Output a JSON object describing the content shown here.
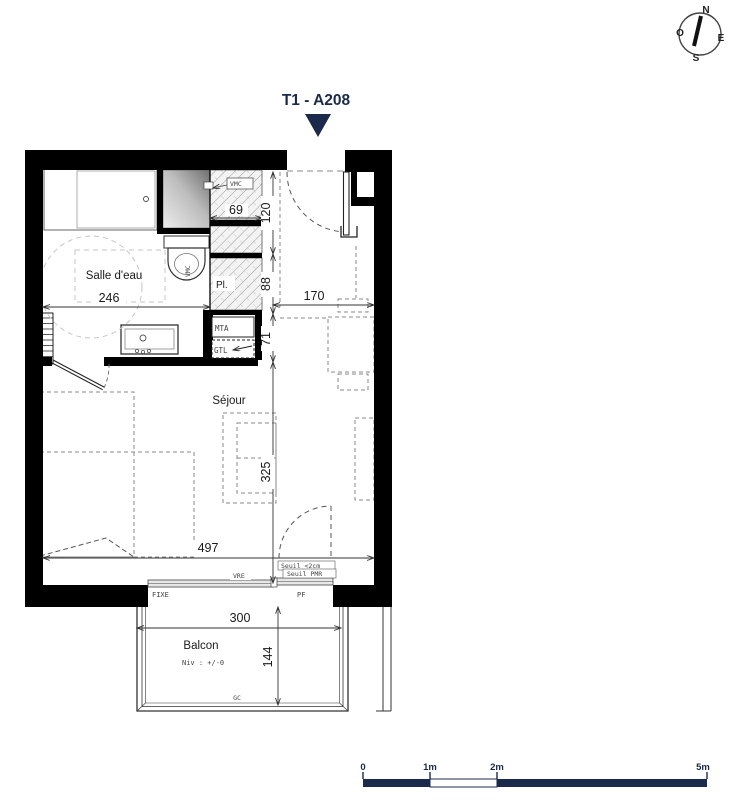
{
  "title": "T1 - A208",
  "compass": {
    "n": "N",
    "o": "O",
    "e": "E",
    "s": "S"
  },
  "rooms": {
    "bathroom": "Salle d'eau",
    "living": "Séjour",
    "balcony": "Balcon",
    "closet": "Pl."
  },
  "dims": {
    "d246": "246",
    "d69": "69",
    "d120": "120",
    "d88": "88",
    "d170": "170",
    "d71": "71",
    "d325": "325",
    "d497": "497",
    "d300": "300",
    "d144": "144"
  },
  "tech": {
    "vmc": "VMC",
    "vmc_wc": "VMC",
    "mta": "MTA",
    "gtl": "GTL",
    "fixe": "FIXE",
    "pf": "PF",
    "vre": "VRE",
    "seuil_cm": "Seuil <2cm",
    "seuil_pmr": "Seuil PMR",
    "niv": "Niv : +/-0",
    "gc": "GC"
  },
  "scalebar": {
    "t0": "0",
    "t1": "1m",
    "t2": "2m",
    "t5": "5m"
  },
  "colors": {
    "navy": "#1b2a4a",
    "wall": "#000000",
    "furniture_dash": "#8a8a8a",
    "hatch_line": "#9a9a9a"
  }
}
